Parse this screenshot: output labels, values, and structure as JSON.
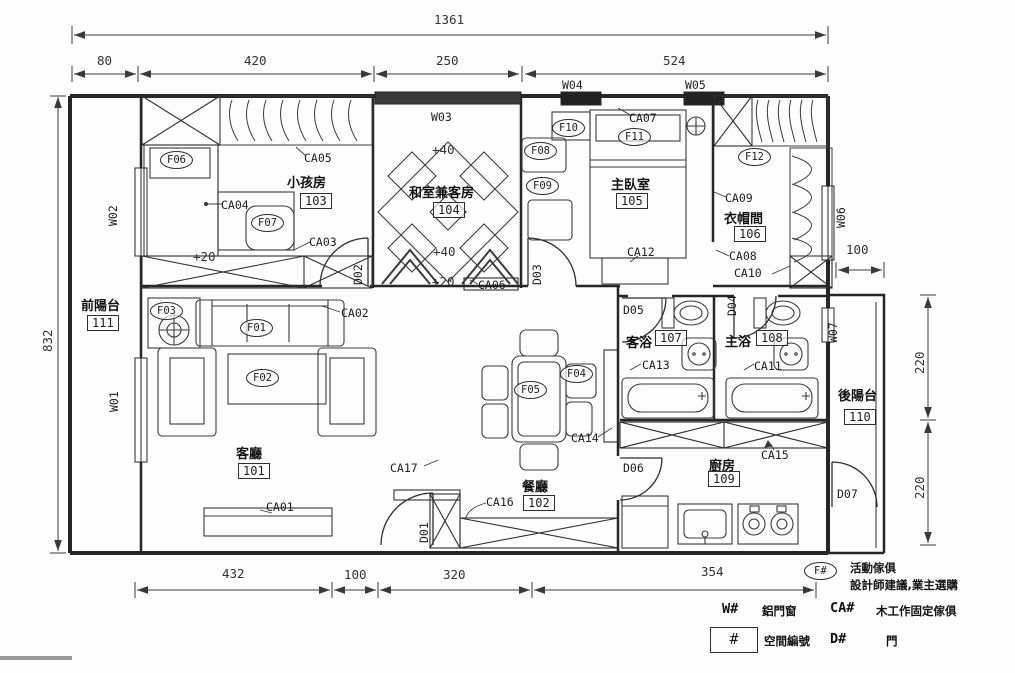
{
  "dims": {
    "overall_width": "1361",
    "overall_height": "832",
    "top": [
      "80",
      "420",
      "250",
      "524"
    ],
    "bottom": [
      "432",
      "100",
      "320",
      "354"
    ],
    "right_upper": "100",
    "right_side": [
      "220",
      "220"
    ]
  },
  "rooms": {
    "living": {
      "name": "客廳",
      "no": "101"
    },
    "dining": {
      "name": "餐廳",
      "no": "102"
    },
    "kids": {
      "name": "小孩房",
      "no": "103"
    },
    "tatami": {
      "name": "和室兼客房",
      "no": "104"
    },
    "master": {
      "name": "主臥室",
      "no": "105"
    },
    "closet": {
      "name": "衣帽間",
      "no": "106"
    },
    "guest_bath": {
      "name": "客浴",
      "no": "107"
    },
    "master_bath": {
      "name": "主浴",
      "no": "108"
    },
    "kitchen": {
      "name": "廚房",
      "no": "109"
    },
    "rear_balcony": {
      "name": "後陽台",
      "no": "110"
    },
    "front_balcony": {
      "name": "前陽台",
      "no": "111"
    }
  },
  "furniture": {
    "f01": "F01",
    "f02": "F02",
    "f03": "F03",
    "f04": "F04",
    "f05": "F05",
    "f06": "F06",
    "f07": "F07",
    "f08": "F08",
    "f09": "F09",
    "f10": "F10",
    "f11": "F11",
    "f12": "F12"
  },
  "cabinets": {
    "ca01": "CA01",
    "ca02": "CA02",
    "ca03": "CA03",
    "ca04": "CA04",
    "ca05": "CA05",
    "ca06": "CA06",
    "ca07": "CA07",
    "ca08": "CA08",
    "ca09": "CA09",
    "ca10": "CA10",
    "ca11": "CA11",
    "ca12": "CA12",
    "ca13": "CA13",
    "ca14": "CA14",
    "ca15": "CA15",
    "ca16": "CA16",
    "ca17": "CA17"
  },
  "doors": {
    "d01": "D01",
    "d02": "D02",
    "d03": "D03",
    "d04": "D04",
    "d05": "D05",
    "d06": "D06",
    "d07": "D07"
  },
  "windows": {
    "w01": "W01",
    "w02": "W02",
    "w03": "W03",
    "w04": "W04",
    "w05": "W05",
    "w06": "W06",
    "w07": "W07"
  },
  "levels": {
    "kids_floor": "+20",
    "tatami_top": "+40",
    "tatami_mid": "+40",
    "tatami_edge": "+20"
  },
  "legend": {
    "movable": {
      "symbol": "F#",
      "line1": "活動傢俱",
      "line2": "設計師建議,業主選購"
    },
    "window": {
      "symbol": "W#",
      "text": "鋁門窗"
    },
    "fixed": {
      "symbol": "CA#",
      "text": "木工作固定傢俱"
    },
    "space": {
      "symbol": "#",
      "text": "空間編號"
    },
    "door": {
      "symbol": "D#",
      "text": "門"
    }
  }
}
